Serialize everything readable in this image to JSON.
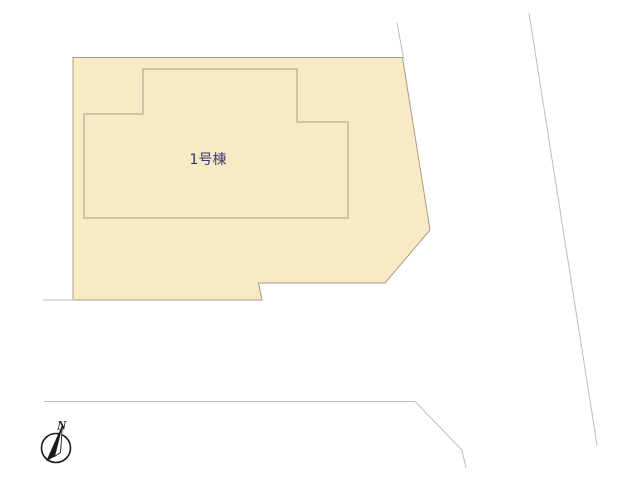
{
  "canvas": {
    "width": 640,
    "height": 480,
    "background": "#FFFFFF"
  },
  "colors": {
    "parcel_fill": "#F9EAC6",
    "parcel_stroke": "#A79C86",
    "building_stroke": "#A79C86",
    "road_line": "#BDBDBD",
    "label_color": "#3A3570",
    "compass_color": "#1A1A1A"
  },
  "parcel": {
    "points": "73,57.5 402.5,57.5 430,230 385,283 258.5,283 262,300 73,300"
  },
  "building": {
    "label": "1号棟",
    "points": "143,69 297,69 297,122 348,122 348,218 84,218 84,114 143,114",
    "label_x": 208,
    "label_y": 164,
    "label_font_size": 14
  },
  "road_lines": [
    {
      "name": "road-edge-left",
      "points": "43,300 72,300"
    },
    {
      "name": "road-edge-bottom",
      "points": "44,401.5 415,401.5 462,450 466,468"
    },
    {
      "name": "road-edge-right-upper",
      "points": "397,23 403.5,58"
    },
    {
      "name": "road-edge-right",
      "points": "529,13 597,445"
    }
  ],
  "compass": {
    "letter": "N",
    "cx": 56,
    "cy": 448,
    "r": 14.5,
    "circle_stroke_width": 1.6,
    "needle_dark_points": "62.5,424.5 46,461.5 54.5,456.5",
    "needle_light_points": "62.5,424.5 54.5,456.5 60.5,452.5",
    "letter_x": 57,
    "letter_y": 429.5,
    "letter_font_size": 13
  }
}
